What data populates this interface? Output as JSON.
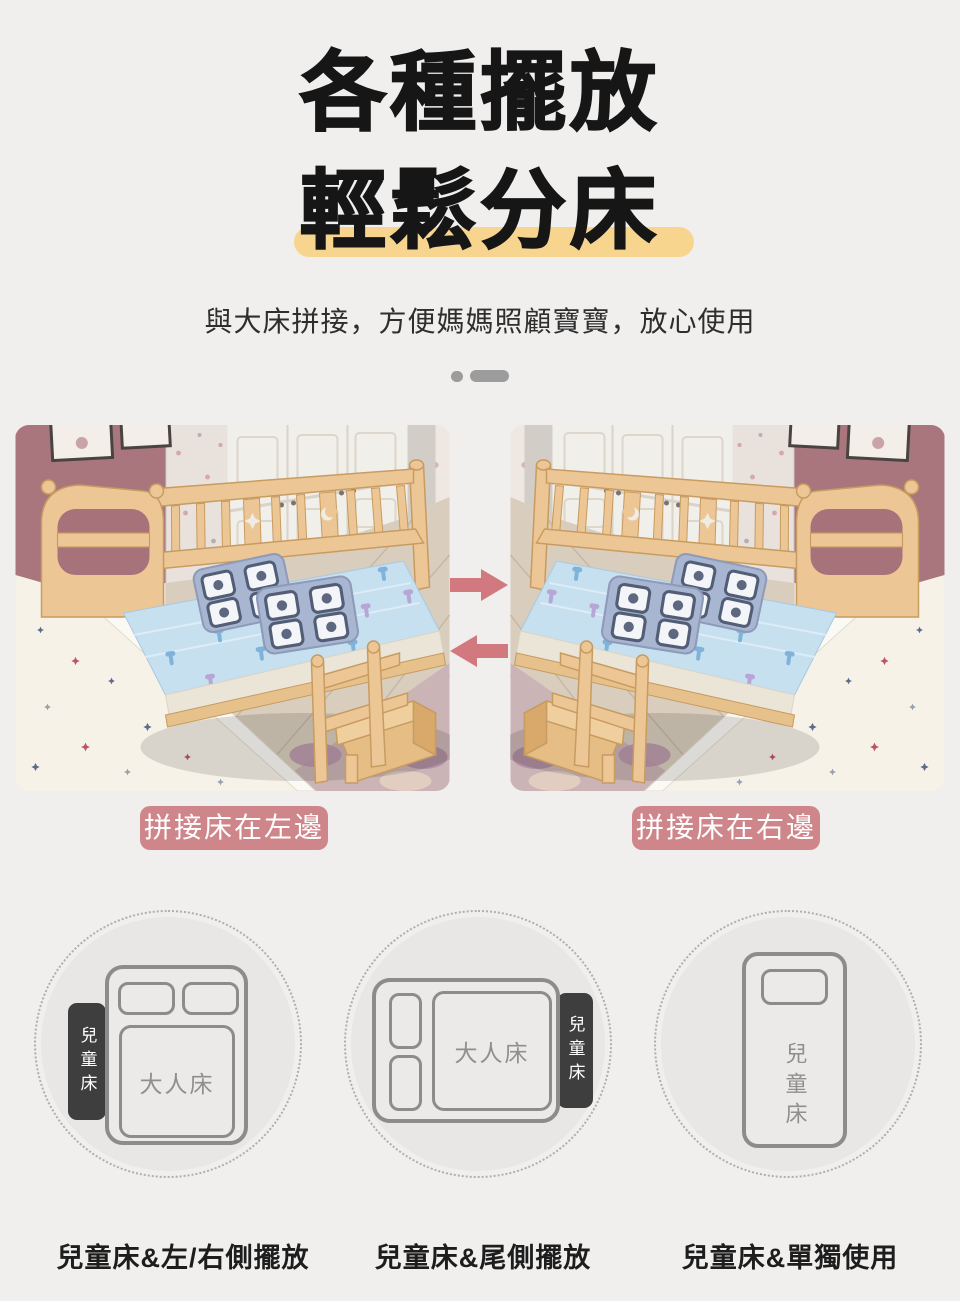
{
  "header": {
    "title_line1": "各種擺放",
    "title_line2": "輕鬆分床",
    "highlight_color": "#f8d58e",
    "subtitle": "與大床拼接，方便媽媽照顧寶寶，放心使用"
  },
  "comparison": {
    "left_label": "拼接床在左邊",
    "right_label": "拼接床在右邊",
    "arrow_color": "#d2797f",
    "label_bg_color": "#cf868b",
    "icons": {
      "swap_right": "→",
      "swap_left": "←"
    }
  },
  "layouts": {
    "items": [
      {
        "caption": "兒童床&左/右側擺放",
        "adult_bed_label": "大人床",
        "child_bed_label": "兒童床"
      },
      {
        "caption": "兒童床&尾側擺放",
        "adult_bed_label": "大人床",
        "child_bed_label": "兒童床"
      },
      {
        "caption": "兒童床&單獨使用",
        "child_bed_label": "兒童床"
      }
    ],
    "dark_tab_color": "#3e3e3e",
    "diagram_line_color": "#8c8c8c"
  }
}
